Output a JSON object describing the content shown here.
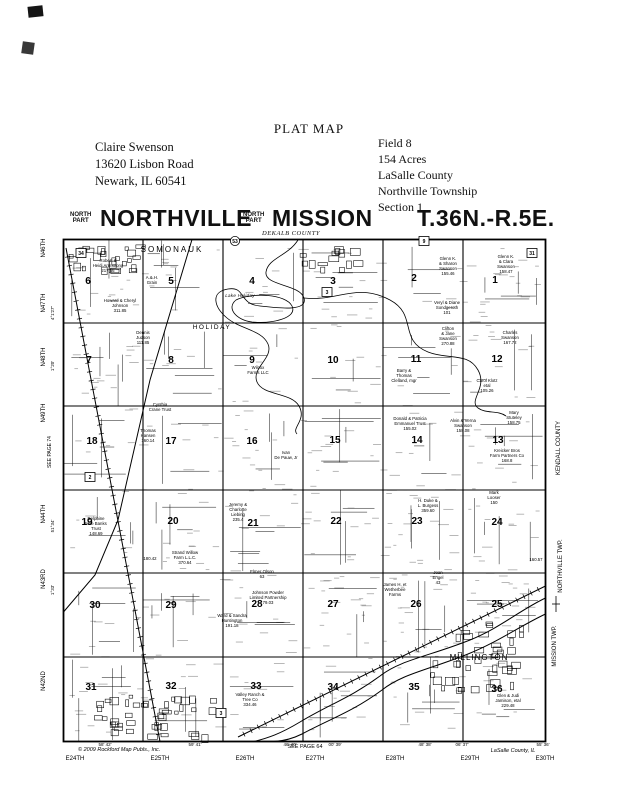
{
  "page_title": "PLAT MAP",
  "owner_block": {
    "lines": [
      "Claire Swenson",
      "13620 Lisbon Road",
      "Newark, IL  60541"
    ]
  },
  "field_block": {
    "lines": [
      "Field 8",
      "154 Acres",
      "LaSalle County",
      "Northville Township",
      "Section 1"
    ]
  },
  "map_title": {
    "small1": "NORTH PART",
    "main1": "NORTHVILLE",
    "small2": "NORTH PART",
    "main2": "MISSION",
    "county_note": "DEKALB COUNTY",
    "township_range": "T.36N.-R.5E."
  },
  "map": {
    "ink_color": "#000000",
    "paper_color": "#ffffff",
    "sections": [
      {
        "n": "6",
        "x": 88,
        "y": 284
      },
      {
        "n": "5",
        "x": 171,
        "y": 284
      },
      {
        "n": "4",
        "x": 252,
        "y": 284
      },
      {
        "n": "3",
        "x": 333,
        "y": 284
      },
      {
        "n": "2",
        "x": 414,
        "y": 281
      },
      {
        "n": "1",
        "x": 495,
        "y": 283
      },
      {
        "n": "7",
        "x": 89,
        "y": 363
      },
      {
        "n": "8",
        "x": 171,
        "y": 363
      },
      {
        "n": "9",
        "x": 252,
        "y": 363
      },
      {
        "n": "10",
        "x": 333,
        "y": 363
      },
      {
        "n": "11",
        "x": 416,
        "y": 362
      },
      {
        "n": "12",
        "x": 497,
        "y": 362
      },
      {
        "n": "18",
        "x": 92,
        "y": 444
      },
      {
        "n": "17",
        "x": 171,
        "y": 444
      },
      {
        "n": "16",
        "x": 252,
        "y": 444
      },
      {
        "n": "15",
        "x": 335,
        "y": 443
      },
      {
        "n": "14",
        "x": 417,
        "y": 443
      },
      {
        "n": "13",
        "x": 498,
        "y": 443
      },
      {
        "n": "19",
        "x": 87,
        "y": 525
      },
      {
        "n": "20",
        "x": 173,
        "y": 524
      },
      {
        "n": "21",
        "x": 253,
        "y": 526
      },
      {
        "n": "22",
        "x": 336,
        "y": 524
      },
      {
        "n": "23",
        "x": 417,
        "y": 524
      },
      {
        "n": "24",
        "x": 497,
        "y": 525
      },
      {
        "n": "30",
        "x": 95,
        "y": 608
      },
      {
        "n": "29",
        "x": 171,
        "y": 608
      },
      {
        "n": "28",
        "x": 257,
        "y": 607
      },
      {
        "n": "27",
        "x": 333,
        "y": 607
      },
      {
        "n": "26",
        "x": 416,
        "y": 607
      },
      {
        "n": "25",
        "x": 497,
        "y": 607
      },
      {
        "n": "31",
        "x": 91,
        "y": 690
      },
      {
        "n": "32",
        "x": 171,
        "y": 689
      },
      {
        "n": "33",
        "x": 256,
        "y": 689
      },
      {
        "n": "34",
        "x": 333,
        "y": 690
      },
      {
        "n": "35",
        "x": 414,
        "y": 690
      },
      {
        "n": "36",
        "x": 497,
        "y": 692
      }
    ],
    "place_labels": [
      {
        "t": "SOMONAUK",
        "x": 172,
        "y": 252,
        "size": 8,
        "ls": 2,
        "italic": false
      },
      {
        "t": "Lake Holiday",
        "x": 240,
        "y": 297,
        "size": 4.5,
        "ls": 0.3,
        "italic": true
      },
      {
        "t": "HOLIDAY",
        "x": 212,
        "y": 329,
        "size": 6.5,
        "ls": 1.5,
        "italic": false
      },
      {
        "t": "MILLINGTON",
        "x": 479,
        "y": 660,
        "size": 8,
        "ls": 1,
        "italic": false
      }
    ],
    "edge_left": [
      {
        "t": "N46TH",
        "x": 45,
        "y": 248,
        "size": 6
      },
      {
        "t": "N47TH",
        "x": 45,
        "y": 303,
        "size": 6
      },
      {
        "t": "4°1'27\"",
        "x": 54,
        "y": 313,
        "size": 4.5
      },
      {
        "t": "N48TH",
        "x": 45,
        "y": 357,
        "size": 6
      },
      {
        "t": "1°20'",
        "x": 54,
        "y": 366,
        "size": 4.5
      },
      {
        "t": "N49TH",
        "x": 45,
        "y": 413,
        "size": 6
      },
      {
        "t": "SEE PAGE 74",
        "x": 51,
        "y": 452,
        "size": 5
      },
      {
        "t": "N44TH",
        "x": 45,
        "y": 514,
        "size": 6
      },
      {
        "t": "51°34'",
        "x": 54,
        "y": 526,
        "size": 4.5
      },
      {
        "t": "N43RD",
        "x": 45,
        "y": 579,
        "size": 6
      },
      {
        "t": "1°33'",
        "x": 54,
        "y": 590,
        "size": 4.5
      },
      {
        "t": "N42ND",
        "x": 45,
        "y": 681,
        "size": 6
      }
    ],
    "edge_right": [
      {
        "t": "KENDALL COUNTY",
        "x": 560,
        "y": 448,
        "size": 6
      },
      {
        "t": "NORTHVILLE TWP.",
        "x": 562,
        "y": 566,
        "size": 6
      },
      {
        "t": "MISSION TWP.",
        "x": 556,
        "y": 646,
        "size": 6
      }
    ],
    "edge_bottom_roads": [
      {
        "t": "E24TH",
        "x": 75
      },
      {
        "t": "E25TH",
        "x": 160
      },
      {
        "t": "E26TH",
        "x": 245
      },
      {
        "t": "E27TH",
        "x": 315
      },
      {
        "t": "E28TH",
        "x": 395
      },
      {
        "t": "E29TH",
        "x": 470
      },
      {
        "t": "E30TH",
        "x": 545
      }
    ],
    "edge_bottom_marks": [
      {
        "t": "58' 42'",
        "x": 105
      },
      {
        "t": "59' 41'",
        "x": 195
      },
      {
        "t": "46' 40'",
        "x": 290
      },
      {
        "t": "00' 39'",
        "x": 335
      },
      {
        "t": "48' 38'",
        "x": 425
      },
      {
        "t": "06' 37'",
        "x": 462
      },
      {
        "t": "55' 36'",
        "x": 543
      }
    ],
    "corner_notes": [
      {
        "t": "© 2009 Rockford Map Publs., Inc.",
        "x": 78,
        "y": 751,
        "size": 5.5,
        "anchor": "start",
        "italic": true
      },
      {
        "t": "SEE PAGE 64",
        "x": 305,
        "y": 748,
        "size": 5.5,
        "anchor": "middle",
        "italic": false
      },
      {
        "t": "LaSalle County, IL",
        "x": 513,
        "y": 752,
        "size": 5.5,
        "anchor": "middle",
        "italic": true
      }
    ],
    "route_shields": [
      {
        "t": "34",
        "x": 81,
        "y": 253,
        "s": "box"
      },
      {
        "t": "53",
        "x": 235,
        "y": 241,
        "s": "circle"
      },
      {
        "t": "9",
        "x": 424,
        "y": 241,
        "s": "box"
      },
      {
        "t": "31",
        "x": 532,
        "y": 253,
        "s": "box"
      },
      {
        "t": "3",
        "x": 327,
        "y": 292,
        "s": "box"
      },
      {
        "t": "3",
        "x": 221,
        "y": 713,
        "s": "box"
      },
      {
        "t": "2",
        "x": 90,
        "y": 477,
        "s": "box"
      }
    ],
    "parcels": [
      {
        "x": 108,
        "y": 262,
        "lines": [
          "Robert &",
          "Heidi Armstrong",
          "217.56"
        ]
      },
      {
        "x": 120,
        "y": 302,
        "lines": [
          "Howard & Cheryl",
          "Johnson",
          "311.85"
        ]
      },
      {
        "x": 143,
        "y": 334,
        "lines": [
          "Dennis",
          "Judson",
          "111.85"
        ]
      },
      {
        "x": 152,
        "y": 279,
        "lines": [
          "A.&.H.",
          "Grain"
        ]
      },
      {
        "x": 160,
        "y": 406,
        "lines": [
          "Cynthia",
          "Crane Trust"
        ]
      },
      {
        "x": 148,
        "y": 432,
        "lines": [
          "Thomas",
          "Hansen",
          "160.14"
        ]
      },
      {
        "x": 258,
        "y": 369,
        "lines": [
          "Wilcox",
          "Farms LLC"
        ]
      },
      {
        "x": 448,
        "y": 260,
        "lines": [
          "Glenn K.",
          "& Sharon",
          "Swanson",
          "155.46"
        ]
      },
      {
        "x": 506,
        "y": 258,
        "lines": [
          "Glenn K.",
          "& Clara",
          "Swanson",
          "158.47"
        ]
      },
      {
        "x": 447,
        "y": 304,
        "lines": [
          "Veryl & Diane",
          "Sondgeroth",
          "101"
        ]
      },
      {
        "x": 448,
        "y": 330,
        "lines": [
          "Clifton",
          "& Jane",
          "Swanson",
          "270.88"
        ]
      },
      {
        "x": 510,
        "y": 334,
        "lines": [
          "Charles",
          "Swanson",
          "167.72"
        ]
      },
      {
        "x": 487,
        "y": 382,
        "lines": [
          "Carol Klotz",
          "etal",
          "105.26"
        ]
      },
      {
        "x": 404,
        "y": 372,
        "lines": [
          "Barry &",
          "Thomas",
          "Clelland, mgr"
        ]
      },
      {
        "x": 410,
        "y": 420,
        "lines": [
          "Donald & Patricia",
          "Emmanuel Trust",
          "155.02"
        ]
      },
      {
        "x": 463,
        "y": 422,
        "lines": [
          "Alvin & Verna",
          "Swanson",
          "158.08"
        ]
      },
      {
        "x": 514,
        "y": 414,
        "lines": [
          "Mary",
          "Stuteley",
          "158.75"
        ]
      },
      {
        "x": 286,
        "y": 454,
        "lines": [
          "Ivan",
          "De Pauw, Jr"
        ]
      },
      {
        "x": 96,
        "y": 520,
        "lines": [
          "Delphine",
          "Mae Banks",
          "Trust",
          "148.69"
        ]
      },
      {
        "x": 150,
        "y": 560,
        "lines": [
          "180.42"
        ]
      },
      {
        "x": 185,
        "y": 554,
        "lines": [
          "Strand Willow",
          "Farm L.L.C.",
          "370.64"
        ]
      },
      {
        "x": 238,
        "y": 506,
        "lines": [
          "Jeremy &",
          "Charlotte",
          "Liebing",
          "235.4"
        ]
      },
      {
        "x": 262,
        "y": 573,
        "lines": [
          "Elmer Olson",
          "63"
        ]
      },
      {
        "x": 268,
        "y": 594,
        "lines": [
          "Johnson Powder",
          "Limited Partnership",
          "79.03"
        ]
      },
      {
        "x": 232,
        "y": 617,
        "lines": [
          "Ward & Sandra",
          "Huntington",
          "191.18"
        ]
      },
      {
        "x": 428,
        "y": 502,
        "lines": [
          "H. Duke &",
          "L. Burgess",
          "359.60"
        ]
      },
      {
        "x": 494,
        "y": 494,
        "lines": [
          "Mark",
          "Looser",
          "150"
        ]
      },
      {
        "x": 536,
        "y": 561,
        "lines": [
          "160.57"
        ]
      },
      {
        "x": 438,
        "y": 574,
        "lines": [
          "Joan",
          "Engel",
          "43"
        ]
      },
      {
        "x": 395,
        "y": 586,
        "lines": [
          "James H. et",
          "Wetherbee",
          "Farms"
        ]
      },
      {
        "x": 250,
        "y": 696,
        "lines": [
          "Valley Ranch &",
          "Tree Co",
          "334.46"
        ]
      },
      {
        "x": 508,
        "y": 697,
        "lines": [
          "Glen & Judi",
          "Jamison, etal",
          "229.48"
        ]
      },
      {
        "x": 507,
        "y": 452,
        "lines": [
          "Kreicker Bros",
          "Farm Partners Co",
          "168.8"
        ]
      }
    ]
  }
}
